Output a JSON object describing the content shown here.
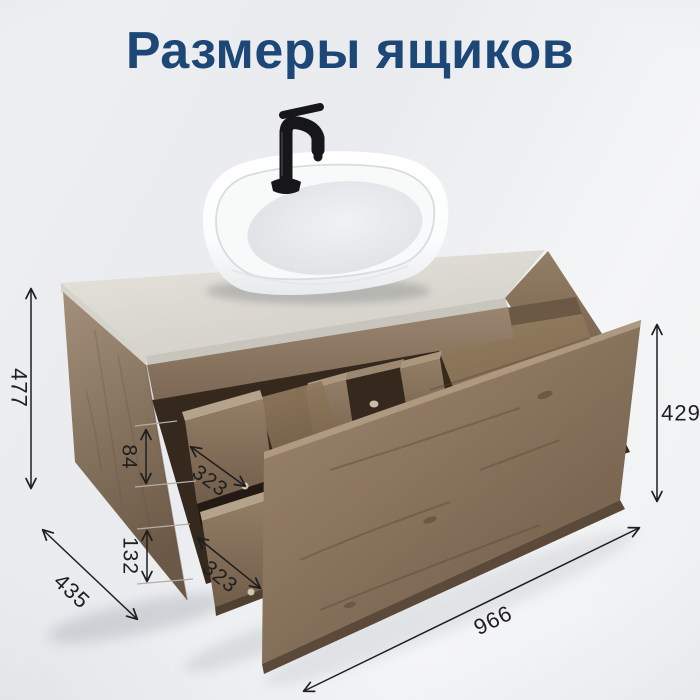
{
  "page": {
    "title": "Размеры ящиков"
  },
  "dimensions": {
    "cabinet_height": "477",
    "top_drawer_inner_height": "84",
    "bottom_drawer_inner_height": "132",
    "top_drawer_depth": "323",
    "bottom_drawer_depth": "323",
    "drawer_front_height": "429",
    "cabinet_depth": "435",
    "cabinet_width": "966"
  },
  "colors": {
    "title": "#1c4777",
    "annotation": "#1f1f1f",
    "background": "#edeff1",
    "wood": "#8c7760",
    "wood_dark_interior": "#35281d",
    "stone_top": "#dedbd3",
    "sink": "#ffffff",
    "faucet": "#17171a"
  }
}
